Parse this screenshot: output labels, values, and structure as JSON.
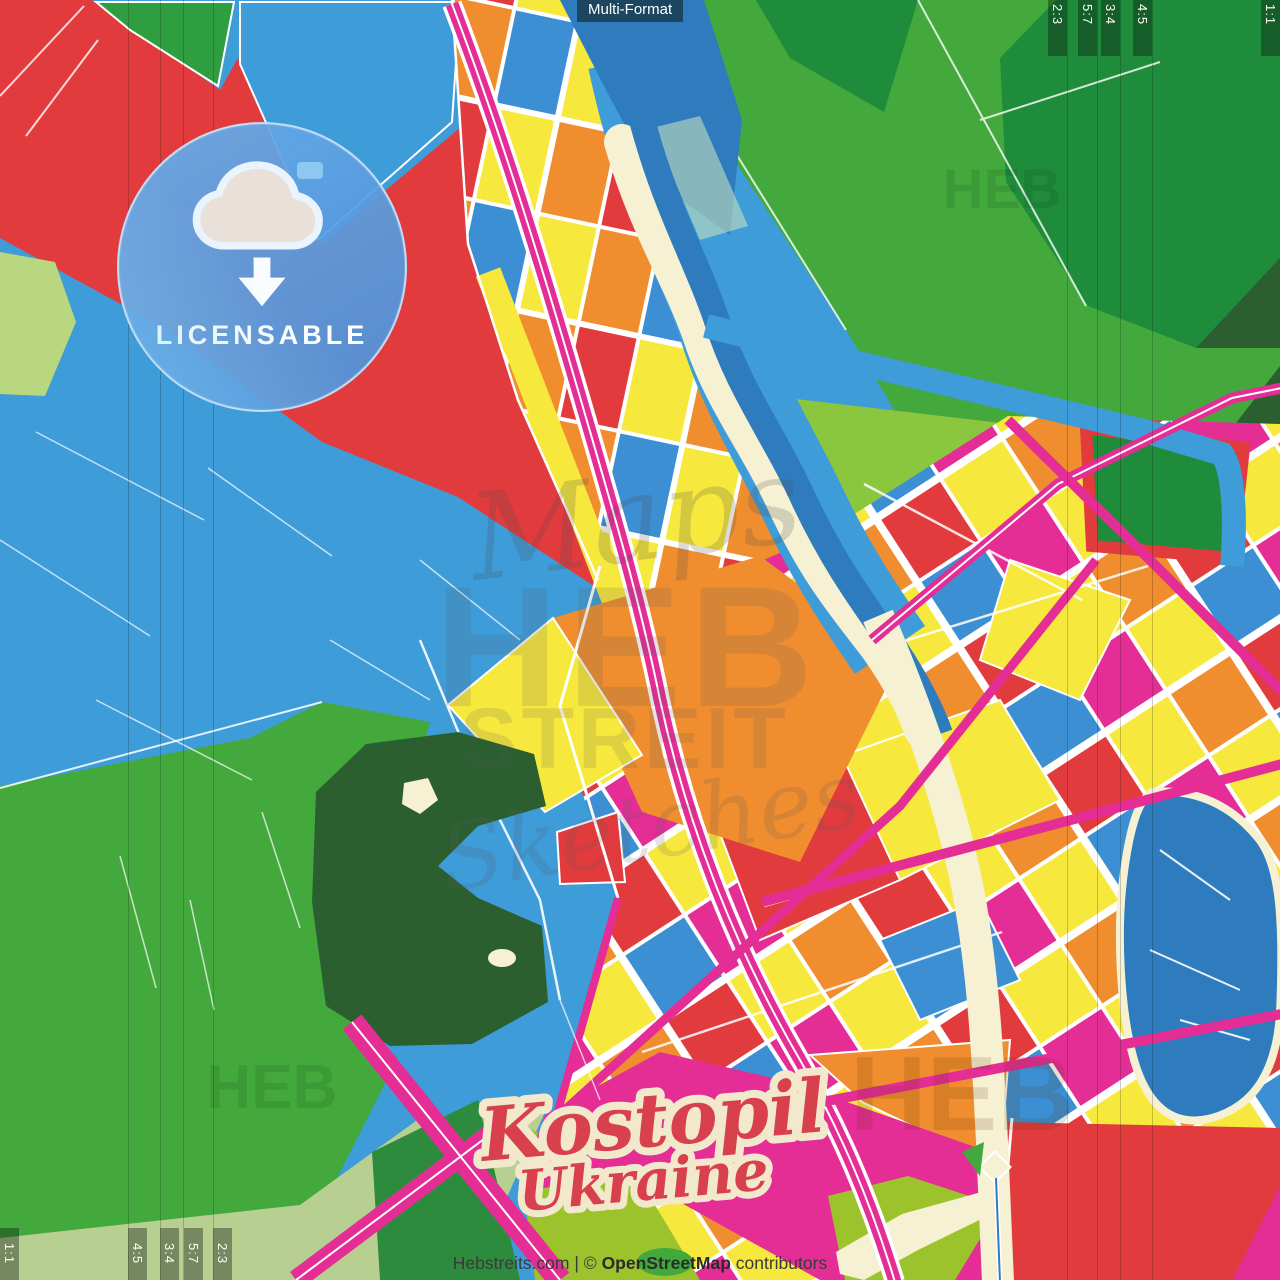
{
  "format_tag": {
    "label": "Multi-Format"
  },
  "license_badge": {
    "label": "LICENSABLE",
    "icon": "cloud-download-icon"
  },
  "crop_guides": {
    "top_right_labels": [
      "2:3",
      "5:7",
      "3:4",
      "4:5",
      "1:1"
    ],
    "bottom_left_labels": [
      "1:1",
      "4:5",
      "3:4",
      "5:7",
      "2:3"
    ]
  },
  "map_title": {
    "city": "Kostopil",
    "country": "Ukraine"
  },
  "watermarks": {
    "script_word": "Maps",
    "brand_top": "HEB",
    "brand_bottom": "STREIT",
    "script_tail": "Sketches",
    "corner_brand": "HEB"
  },
  "footer": {
    "site": "Hebstreits.com",
    "separator": "|",
    "copyright_symbol": "©",
    "source": "OpenStreetMap",
    "suffix": "contributors"
  },
  "map_palette": {
    "water": "#3E9CD9",
    "river": "#2E7CBE",
    "red": "#E23B3E",
    "green": "#43A93C",
    "dark_green": "#1E8C3B",
    "forest": "#2B5F30",
    "lime": "#9CC22C",
    "sage": "#B8CF92",
    "yellow": "#F7E83D",
    "orange": "#EF8D2F",
    "magenta": "#E52D96",
    "cream": "#F6F1D3",
    "street": "#FFFFFF",
    "badge_blue": "#5FA3E3",
    "title_red": "#D8404D",
    "title_outline": "#F2E9CD"
  }
}
